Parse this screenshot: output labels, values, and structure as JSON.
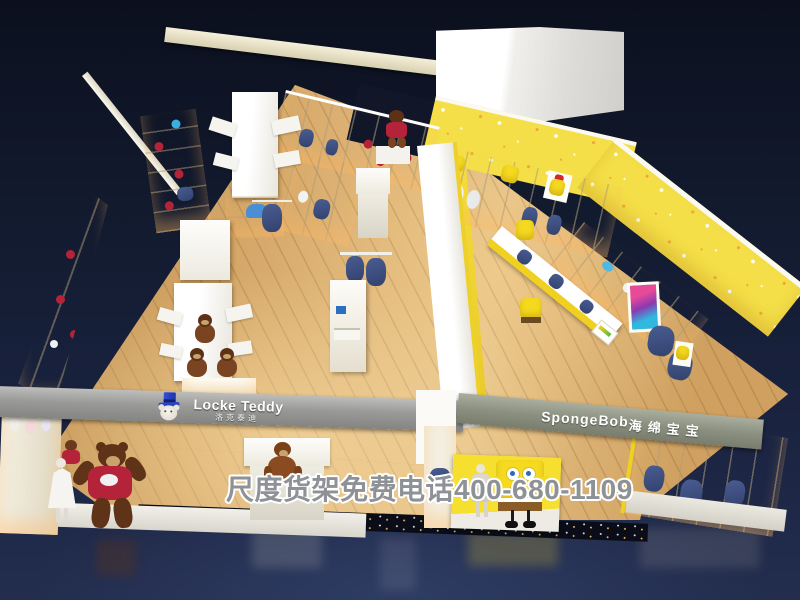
{
  "image": {
    "type": "3d-store-render",
    "description": "Bird's-eye 3D rendering of a children's clothing shop-in-shop with a Locke Teddy zone (white/cream, teddy bears) and a SpongeBob zone (yellow, star-pattern walls)",
    "watermark_text": "尺度货架免费电话400-680-1109"
  },
  "brands": {
    "locke_teddy": {
      "name": "Locke Teddy",
      "chinese": "洛克泰迪",
      "logo_icon": "teddy-bear-with-blue-top-hat"
    },
    "spongebob": {
      "name": "SpongeBob",
      "chinese": "海绵宝宝"
    }
  },
  "palette": {
    "background_navy": "#131a2e",
    "wood_floor": "#d8ab6c",
    "sign_beam_gray": "#8f948a",
    "cream_beam": "#e9e2c6",
    "shelving_white": "#f4f0e4",
    "spongebob_yellow": "#f5dd2e",
    "yellow_wall": "#f2df52",
    "denim_blue": "#3d4f80",
    "teddy_brown": "#6a3a1c",
    "teddy_shirt_red": "#b5233a",
    "logo_hat_blue": "#2a46c4"
  }
}
